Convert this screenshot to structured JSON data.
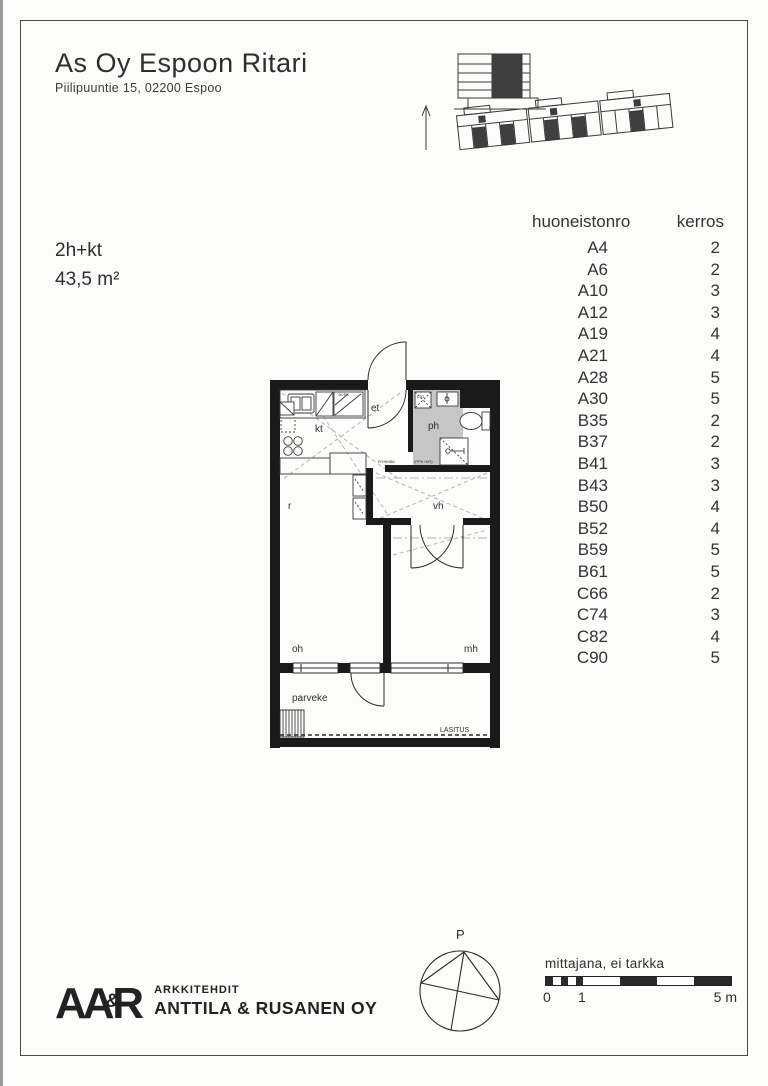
{
  "header": {
    "title": "As Oy Espoon Ritari",
    "address": "Piilipuuntie 15, 02200 Espoo"
  },
  "summary": {
    "type": "2h+kt",
    "area": "43,5 m²"
  },
  "table": {
    "header": {
      "unit_col": "huoneistonro",
      "floor_col": "kerros"
    },
    "rows": [
      {
        "unit": "A4",
        "floor": "2"
      },
      {
        "unit": "A6",
        "floor": "2"
      },
      {
        "unit": "A10",
        "floor": "3"
      },
      {
        "unit": "A12",
        "floor": "3"
      },
      {
        "unit": "A19",
        "floor": "4"
      },
      {
        "unit": "A21",
        "floor": "4"
      },
      {
        "unit": "A28",
        "floor": "5"
      },
      {
        "unit": "A30",
        "floor": "5"
      },
      {
        "unit": "B35",
        "floor": "2"
      },
      {
        "unit": "B37",
        "floor": "2"
      },
      {
        "unit": "B41",
        "floor": "3"
      },
      {
        "unit": "B43",
        "floor": "3"
      },
      {
        "unit": "B50",
        "floor": "4"
      },
      {
        "unit": "B52",
        "floor": "4"
      },
      {
        "unit": "B59",
        "floor": "5"
      },
      {
        "unit": "B61",
        "floor": "5"
      },
      {
        "unit": "C66",
        "floor": "2"
      },
      {
        "unit": "C74",
        "floor": "3"
      },
      {
        "unit": "C82",
        "floor": "4"
      },
      {
        "unit": "C90",
        "floor": "5"
      }
    ]
  },
  "floorplan": {
    "rooms": {
      "kt": "kt",
      "et": "et",
      "ph": "ph",
      "vh": "vh",
      "r": "r",
      "oh": "oh",
      "mh": "mh",
      "parveke": "parveke"
    },
    "annotations": {
      "lasitus": "LASITUS",
      "lto": "LTO",
      "jkpk": "JK/PK",
      "ppk_kr": "(PPK+KR)",
      "ryhmak": "RYHMÄK"
    }
  },
  "compass": {
    "north_label": "P"
  },
  "logo": {
    "part1": "AA",
    "amp": "&",
    "part2": "R",
    "line1": "ARKKITEHDIT",
    "line2": "ANTTILA & RUSANEN OY"
  },
  "scalebar": {
    "caption": "mittajana, ei tarkka",
    "tick0": "0",
    "tick1": "1",
    "tick5": "5 m"
  },
  "colors": {
    "ink": "#333333",
    "wall": "#1a1a1a",
    "bath_gray": "#c6c6c6"
  }
}
